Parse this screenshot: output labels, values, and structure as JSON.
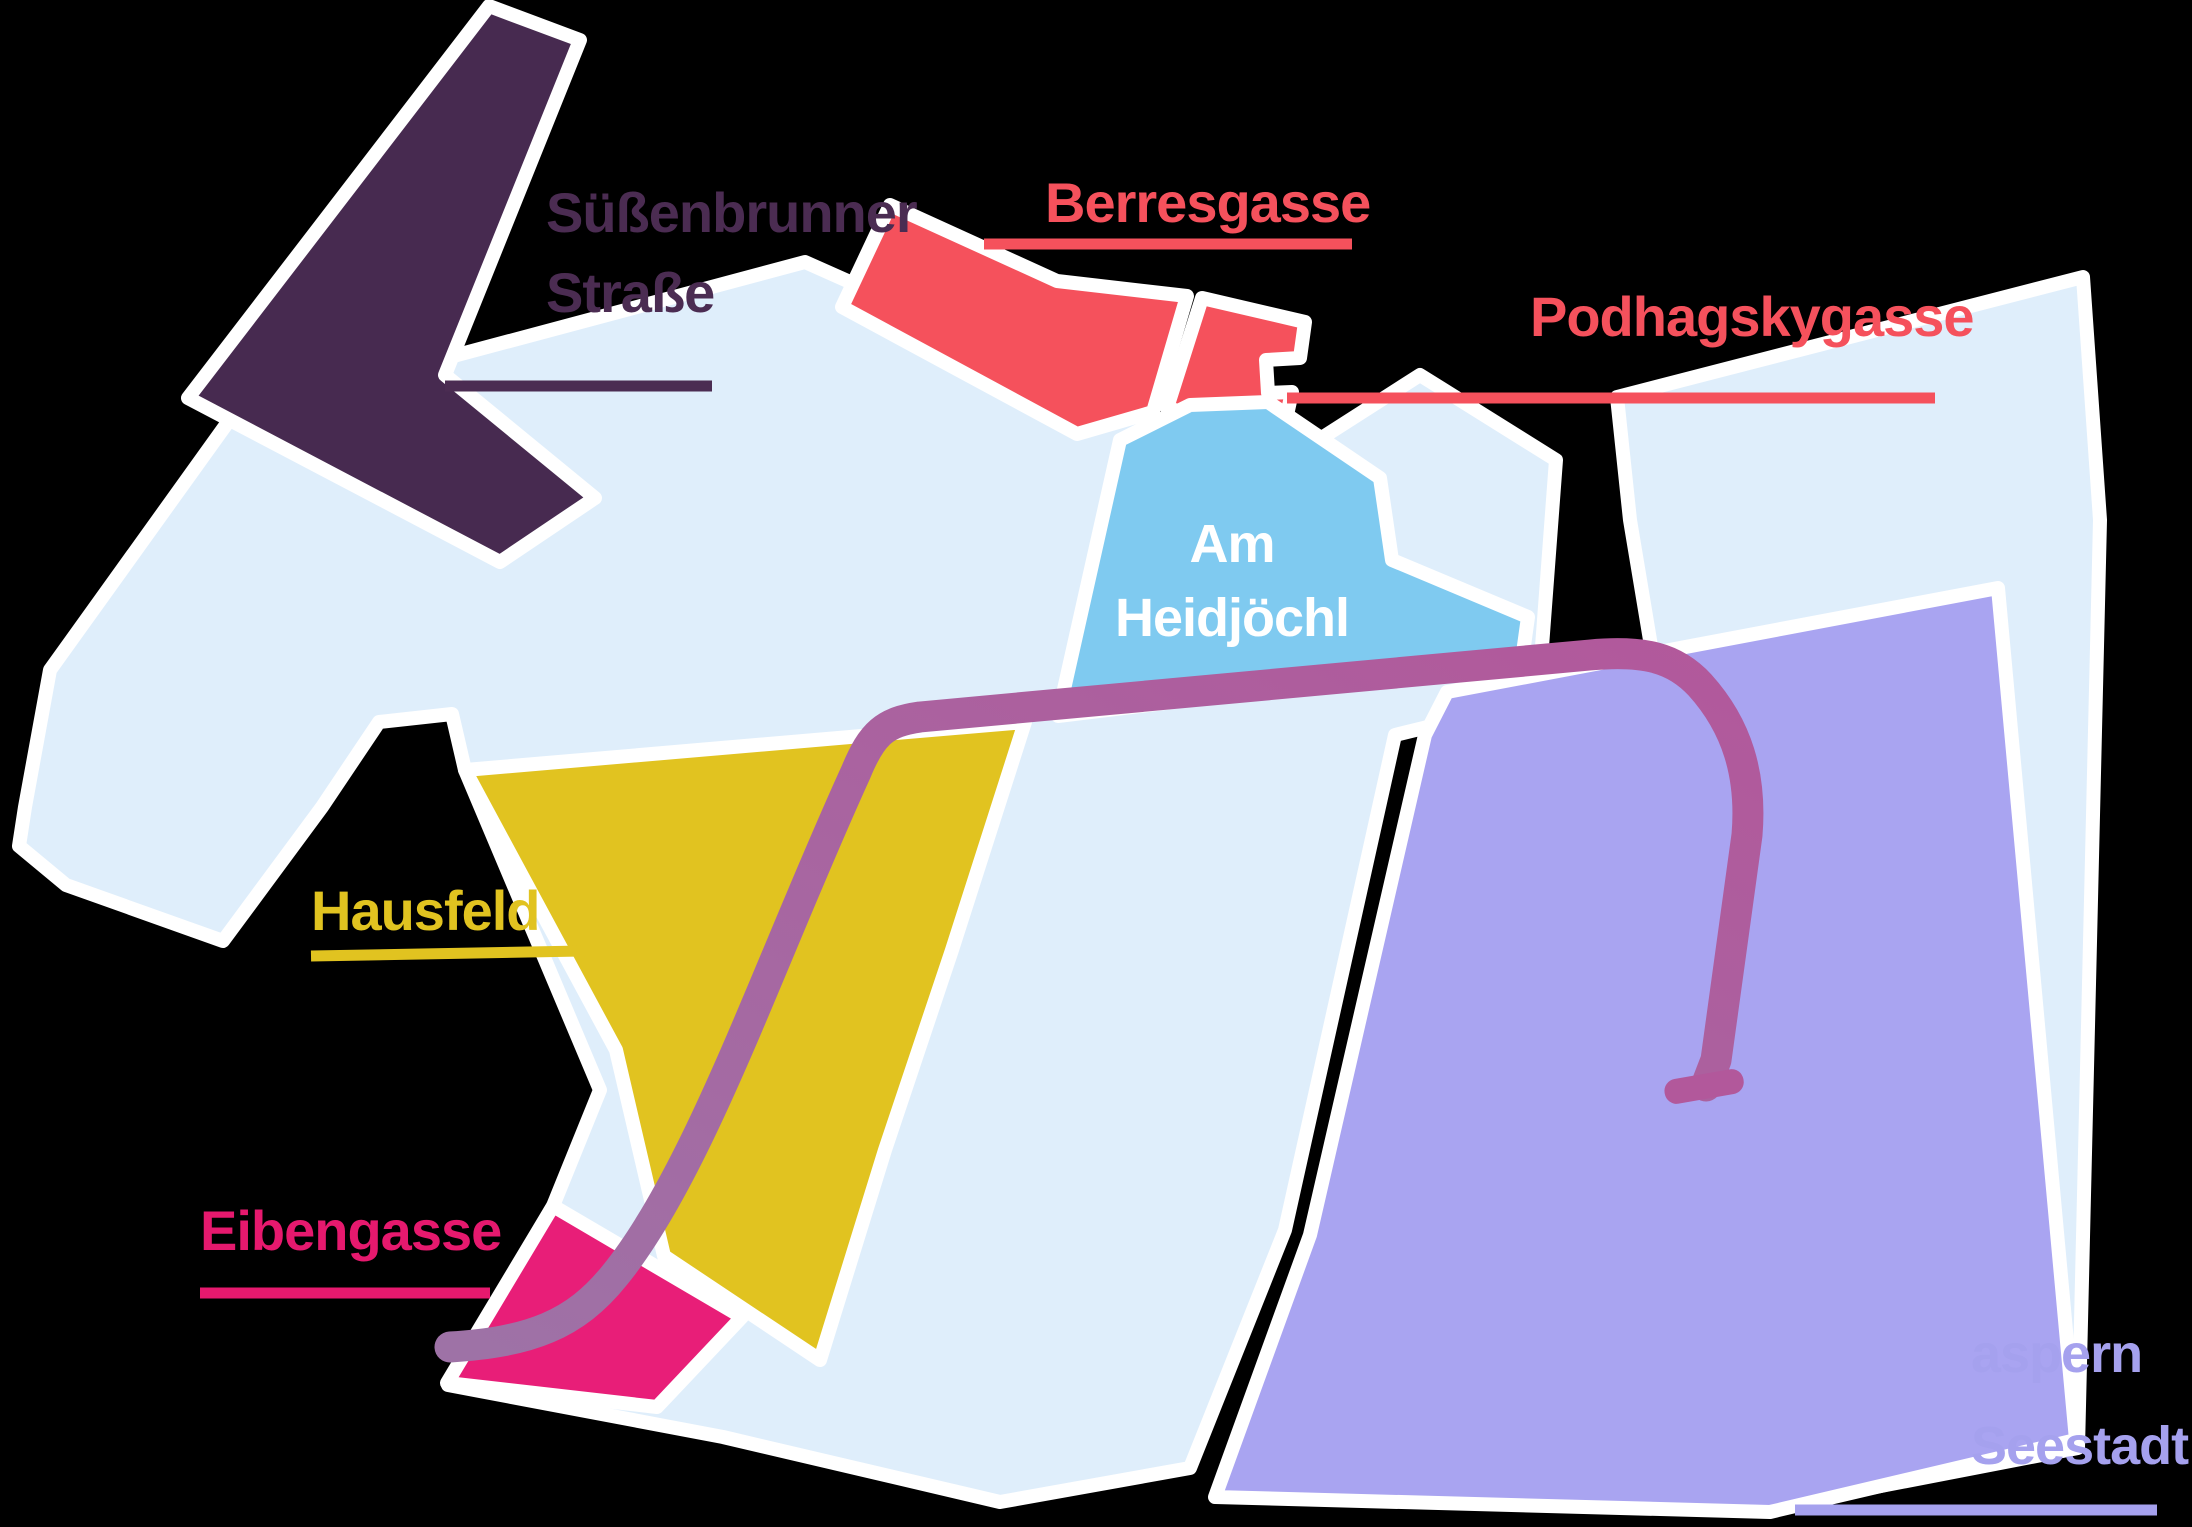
{
  "canvas": {
    "background_color": "#000000",
    "land_color": "#dfeefb",
    "outline_color": "#ffffff"
  },
  "regions": [
    {
      "name": "suessenbrunner-strasse",
      "label": "Süßenbrunner Straße",
      "label_lines": [
        "Süßenbrunner",
        "Straße"
      ],
      "color": "#472a50",
      "label_color": "#4b2c52",
      "leader_color": "#4b2c52"
    },
    {
      "name": "berresgasse",
      "label": "Berresgasse",
      "color": "#f5515c",
      "label_color": "#f5515c",
      "leader_color": "#f5515c"
    },
    {
      "name": "podhagskygasse",
      "label": "Podhagskygasse",
      "color": "#f5515c",
      "label_color": "#f5515c",
      "leader_color": "#f5515c"
    },
    {
      "name": "am-heidjoechl",
      "label": "Am Heidjöchl",
      "label_lines": [
        "Am",
        "Heidjöchl"
      ],
      "color": "#7fcaf0",
      "label_color": "#ffffff",
      "leader_color": "#7fcaf0"
    },
    {
      "name": "hausfeld",
      "label": "Hausfeld",
      "color": "#e1c320",
      "label_color": "#e1c320",
      "leader_color": "#e1c320"
    },
    {
      "name": "eibengasse",
      "label": "Eibengasse",
      "color": "#e81e78",
      "label_color": "#e6196e",
      "leader_color": "#e6196e"
    },
    {
      "name": "aspern-seestadt",
      "label": "aspern Seestadt",
      "label_lines": [
        "aspern",
        "Seestadt"
      ],
      "color": "#a9a4f1",
      "label_color": "#a5a1ee",
      "leader_color": "#a5a1ee"
    }
  ],
  "route": {
    "name": "metro-route-line",
    "color_start": "#9e72a6",
    "color_end": "#b2589b"
  }
}
